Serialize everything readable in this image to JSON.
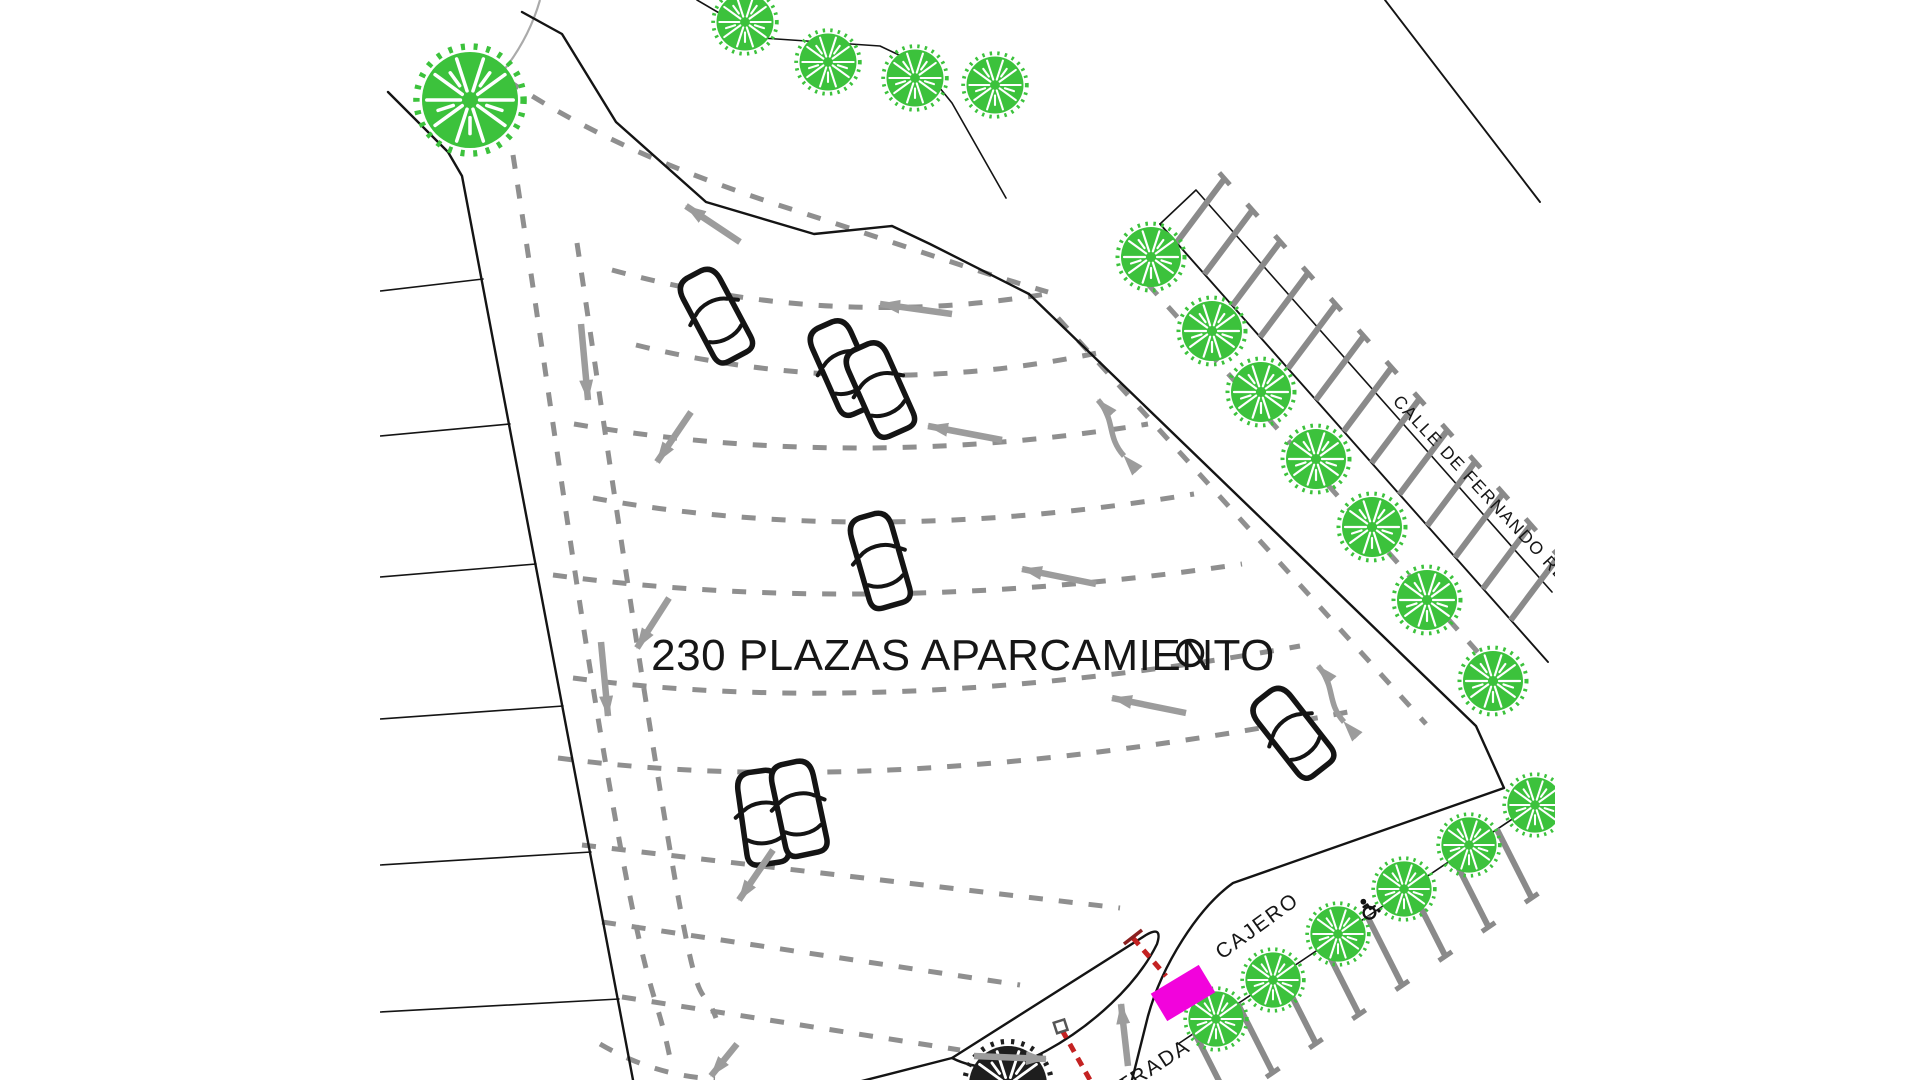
{
  "plan": {
    "capacity_label": "230 PLAZAS APARCAMIENTO",
    "capacity": 230,
    "street_label": "CALLE DE FERNANDO REMAC",
    "atm_label": "CAJERO",
    "entrance_label": "ENTRADA"
  },
  "symbols": {
    "tree_icon": "tree",
    "dark_tree_icon": "tree-dark",
    "car_icon": "parked-car",
    "wheelchair_icon": "accessible-parking",
    "atm_marker": "ATM location marker",
    "barrier_icon": "gate-barrier",
    "arrow_icon": "traffic-flow-arrow",
    "two_way_arrow_icon": "two-way-flow-arrow"
  },
  "colors": {
    "background": "#ffffff",
    "line_black": "#141414",
    "dash_gray": "#8f8f8f",
    "arrow_gray": "#9c9c9c",
    "tick_gray": "#8a8a8a",
    "tree_green": "#3cc23c",
    "dark_tree": "#1e1e1e",
    "atm_magenta": "#f203dc",
    "barrier_red": "#c42222"
  }
}
